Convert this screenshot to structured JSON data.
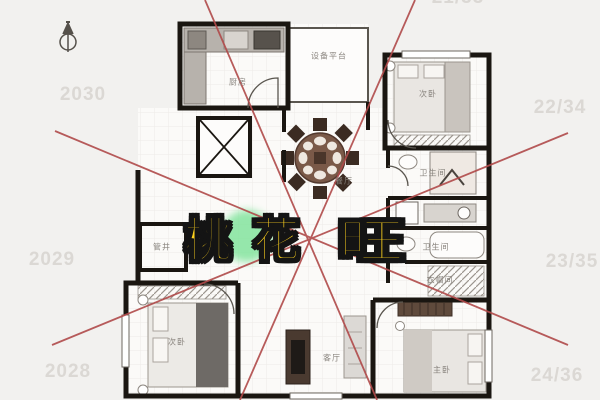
{
  "title": {
    "text": "桃花旺",
    "chars": [
      "桃",
      "花",
      "旺"
    ],
    "color": "#ffd21e"
  },
  "compass": {
    "name": "north-arrow"
  },
  "floor_plan": {
    "rooms": [
      {
        "label": "厨房"
      },
      {
        "label": "设备平台"
      },
      {
        "label": "次卧"
      },
      {
        "label": "餐厅"
      },
      {
        "label": "卫生间"
      },
      {
        "label": "管井"
      },
      {
        "label": "卫生间"
      },
      {
        "label": "衣帽间"
      },
      {
        "label": "次卧"
      },
      {
        "label": "客厅"
      },
      {
        "label": "主卧"
      }
    ]
  },
  "year_labels": {
    "left": [
      {
        "text": "2030"
      },
      {
        "text": "2029"
      },
      {
        "text": "2028"
      }
    ],
    "right": [
      {
        "text": "21/33"
      },
      {
        "text": "22/34"
      },
      {
        "text": "23/35"
      },
      {
        "text": "24/36"
      }
    ]
  },
  "colors": {
    "background": "#f2f1ef",
    "floor": "#fbfaf8",
    "wall": "#1a1611",
    "line_red": "#b04a4a",
    "highlight_green": "#7ce398",
    "title_yellow": "#ffd21e",
    "year_label_gray": "#dbd8d4"
  }
}
